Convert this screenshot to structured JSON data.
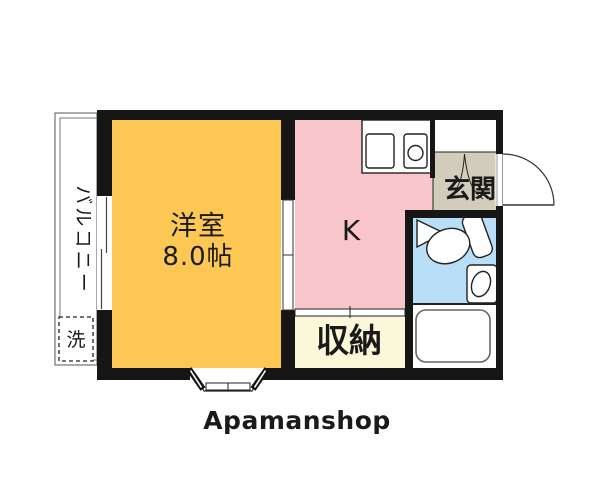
{
  "floorplan": {
    "branding": {
      "logo_text": "Apamanshop",
      "logo_color": "#7a7a7a"
    },
    "walls_color": "#161616",
    "rooms": {
      "living": {
        "name": "洋室",
        "size": "8.0帖",
        "color": "#FCC853"
      },
      "kitchen": {
        "label": "K",
        "color": "#F9C6CB"
      },
      "storage": {
        "label": "収納",
        "color": "#FBF8D9"
      },
      "entrance": {
        "label": "玄関",
        "color": "#D2CCBA"
      },
      "toilet": {
        "color": "#B8DFF7"
      },
      "bath": {
        "color": "#FFFFFF"
      },
      "balcony": {
        "label": "バルコニー"
      },
      "washing_machine": {
        "label": "洗"
      }
    }
  }
}
